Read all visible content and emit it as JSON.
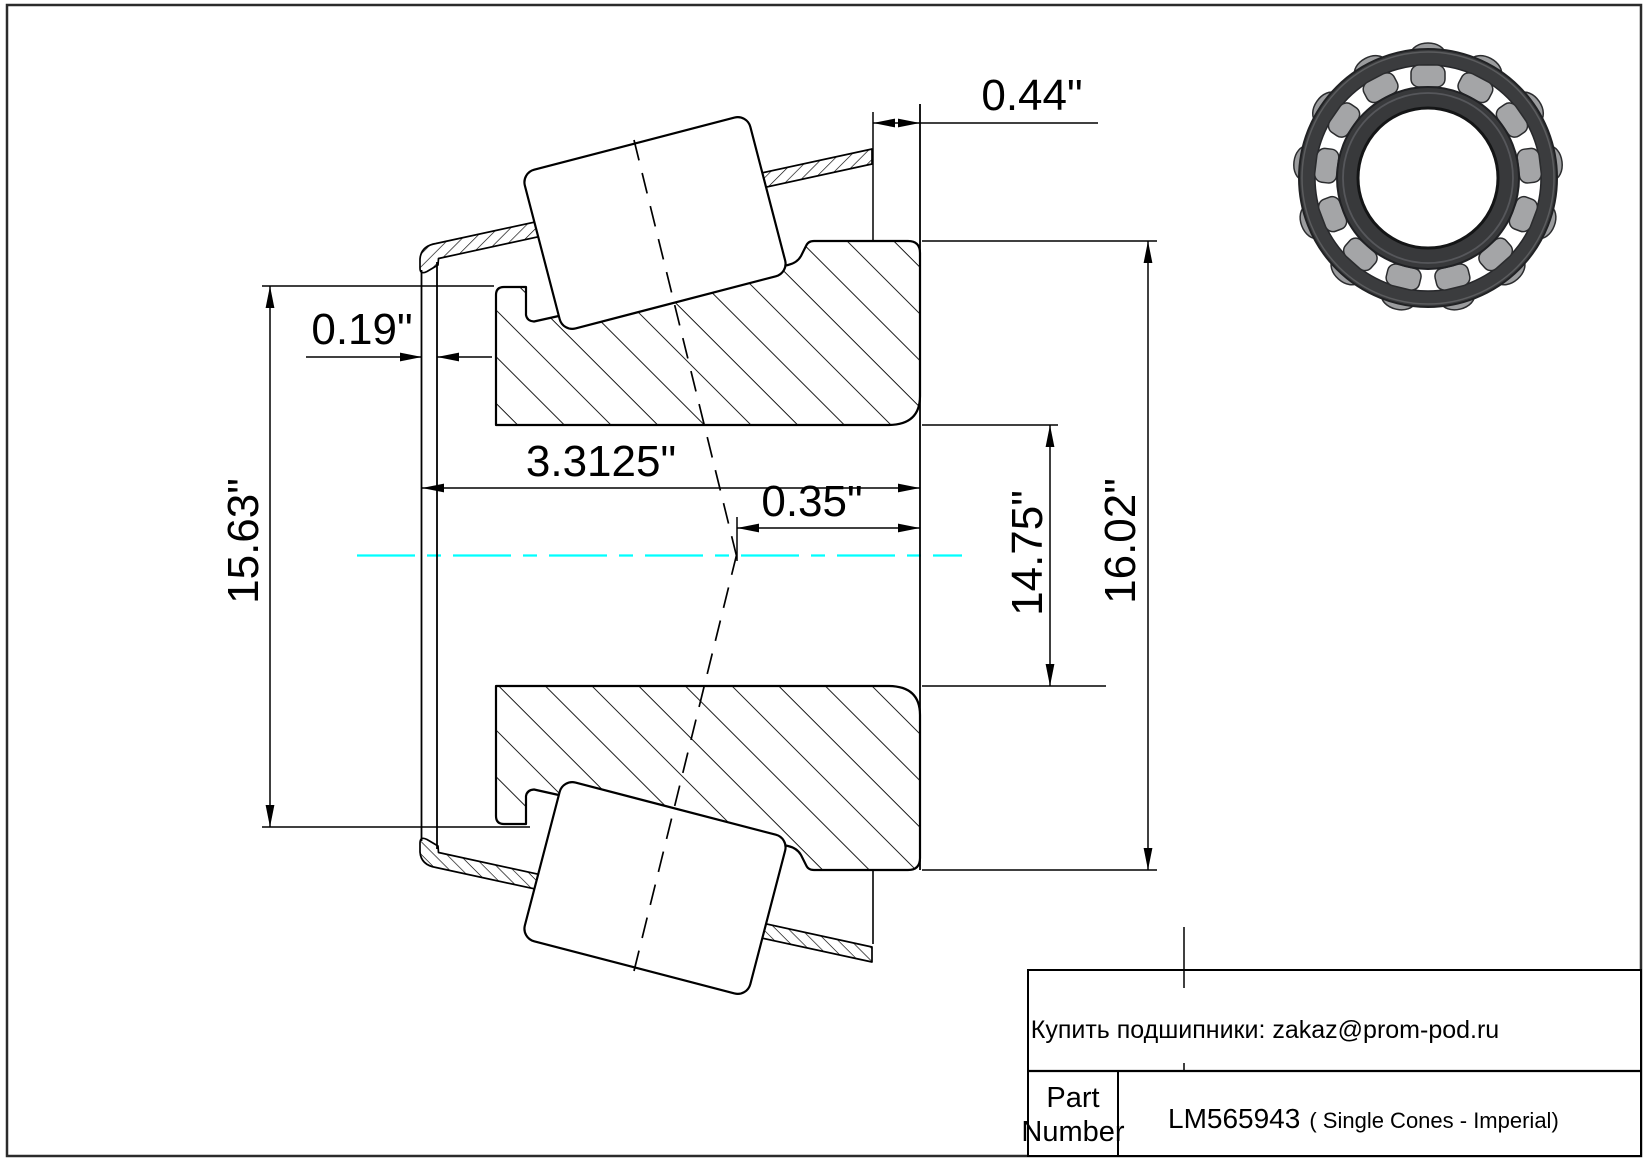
{
  "dimensions": {
    "cup_offset": "0.44\"",
    "lip_gap": "0.19\"",
    "cone_width": "3.3125\"",
    "apex_offset": "0.35\"",
    "flange_diameter": "15.63\"",
    "bore_diameter": "14.75\"",
    "outer_diameter": "16.02\""
  },
  "title_block": {
    "vendor_note": "Купить подшипники: zakaz@prom-pod.ru",
    "part_label_line1": "Part",
    "part_label_line2": "Number",
    "part_number": "LM565943",
    "part_description": "( Single Cones - Imperial)"
  },
  "colors": {
    "centerline": "#00ffff",
    "line": "#000000",
    "bearing_ring": "#3b3c3e",
    "bearing_roller": "#a4a5a7"
  }
}
